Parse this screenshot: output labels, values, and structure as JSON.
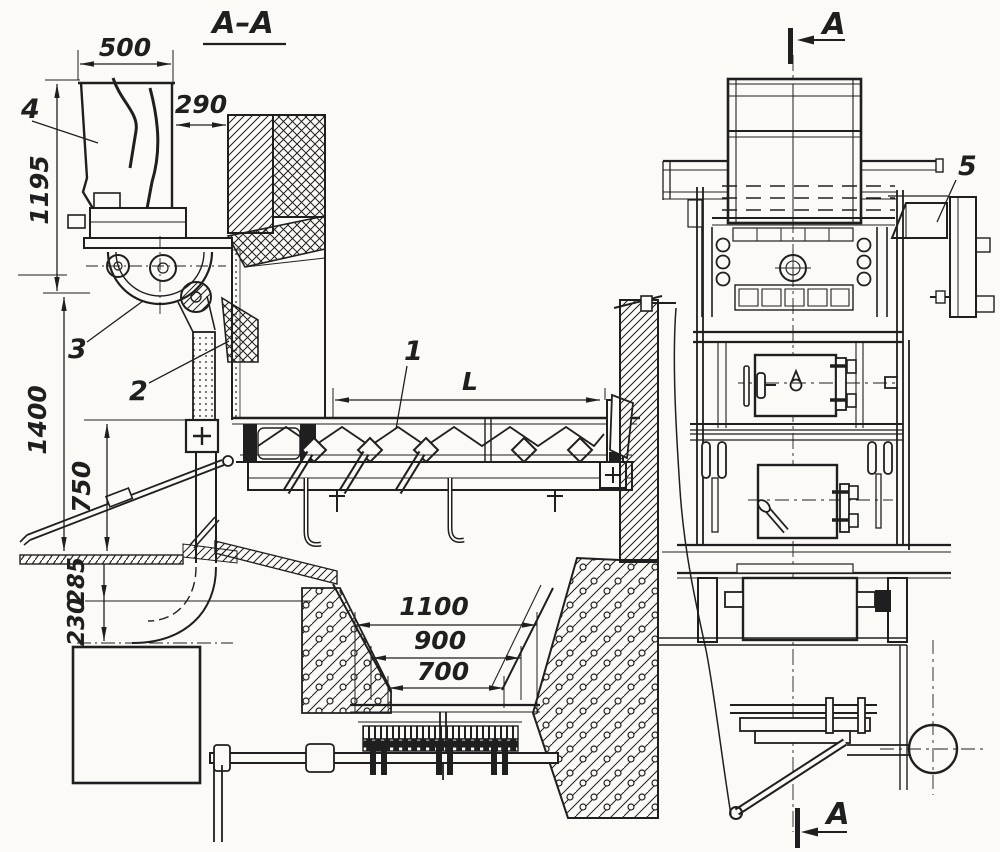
{
  "palette": {
    "ink": "#1f1f1f",
    "paper": "#fbfaf6"
  },
  "section_view": {
    "title": "A–A",
    "dimensions": {
      "hopper_width": "500",
      "hopper_to_wall": "290",
      "hopper_height": "1195",
      "feed_height": "1400",
      "conveyor_height": "750",
      "floor_drop_upper": "285",
      "floor_drop_lower": "230",
      "conveyor_length": "L",
      "pit_outer": "1100",
      "pit_middle": "900",
      "pit_inner": "700"
    },
    "part_labels": {
      "screw_conveyor": "1",
      "chute": "2",
      "feeder": "3",
      "hopper": "4"
    }
  },
  "front_view": {
    "part_labels": {
      "drive_unit": "5"
    },
    "section_marker_top": "A",
    "section_marker_bottom": "A"
  }
}
